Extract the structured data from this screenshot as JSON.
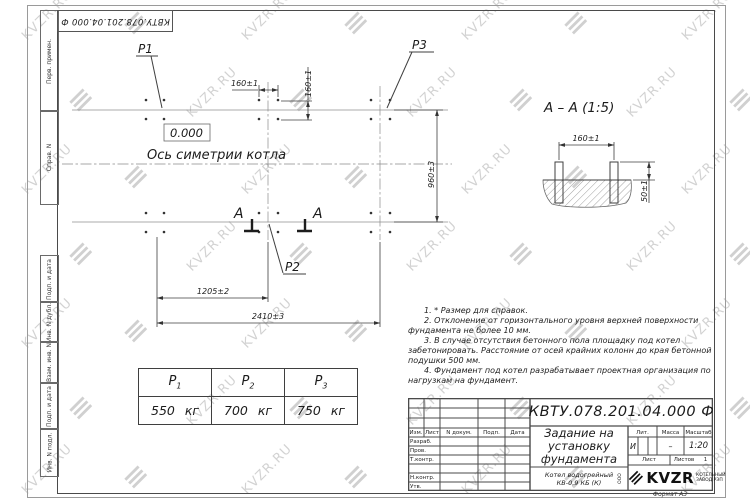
{
  "designation": "КВТУ.078.201.04.000  Ф",
  "watermark": {
    "text": "KVZR.RU",
    "icon": "≡",
    "color": "#cbcbcb"
  },
  "frame_left": [
    "Перв. примен.",
    "Справ. N",
    "Подп. и дата",
    "Инв. N дубл.",
    "Взам. инв. N",
    "Подп. и дата",
    "Инв. N подл."
  ],
  "plan": {
    "elevation": "0.000",
    "axis_label": "Ось симетрии котла",
    "p1": "P1",
    "p2": "P2",
    "p3": "P3",
    "section_letter": "А",
    "dim_160_top": "160±1",
    "dim_160_side": "160±1",
    "dim_960": "960±3",
    "dim_1205": "1205±2",
    "dim_2410": "2410±3"
  },
  "section_view": {
    "title": "А – А (1:5)",
    "dim_160": "160±1",
    "dim_50": "50±1"
  },
  "notes": [
    "1. * Размер для справок.",
    "2. Отклонение от горизонтального уровня верхней поверхности фундамента не более 10 мм.",
    "3. В случае отсутствия бетонного пола площадку под котел забетонировать. Расстояние от осей крайних колонн до края бетонной подушки 500 мм.",
    "4. Фундамент под котел разрабатывает проектная организация по нагрузкам на фундамент."
  ],
  "load_table": {
    "headers": [
      {
        "base": "P",
        "sub": "1"
      },
      {
        "base": "P",
        "sub": "2"
      },
      {
        "base": "P",
        "sub": "3"
      }
    ],
    "values": [
      "550 кг",
      "700 кг",
      "750 кг"
    ]
  },
  "title_block": {
    "doc_title": [
      "Задание на",
      "установку",
      "фундамента"
    ],
    "product": [
      "Котел водогрейный",
      "КВ-0,9 КБ (К)"
    ],
    "cols": {
      "izm": "Изм.",
      "list": "Лист",
      "ndoc": "N докум.",
      "podp": "Подп.",
      "data": "Дата"
    },
    "rows": [
      "Разраб.",
      "Пров.",
      "Т.контр.",
      "",
      "Н.контр.",
      "Утв."
    ],
    "lit_label": "Лит.",
    "lit_value": "И",
    "mass_label": "Масса",
    "mass_value": "–",
    "scale_label": "Масштаб",
    "scale_value": "1:20",
    "sheet_label": "Лист",
    "sheets_label": "Листов",
    "sheets_value": "1",
    "logo": {
      "ooo": "ООО",
      "name": "KVZR",
      "line1": "КОТЕЛЬНЫЙ",
      "line2": "ЗАВОД РЭП"
    },
    "format": "Формат А3"
  }
}
